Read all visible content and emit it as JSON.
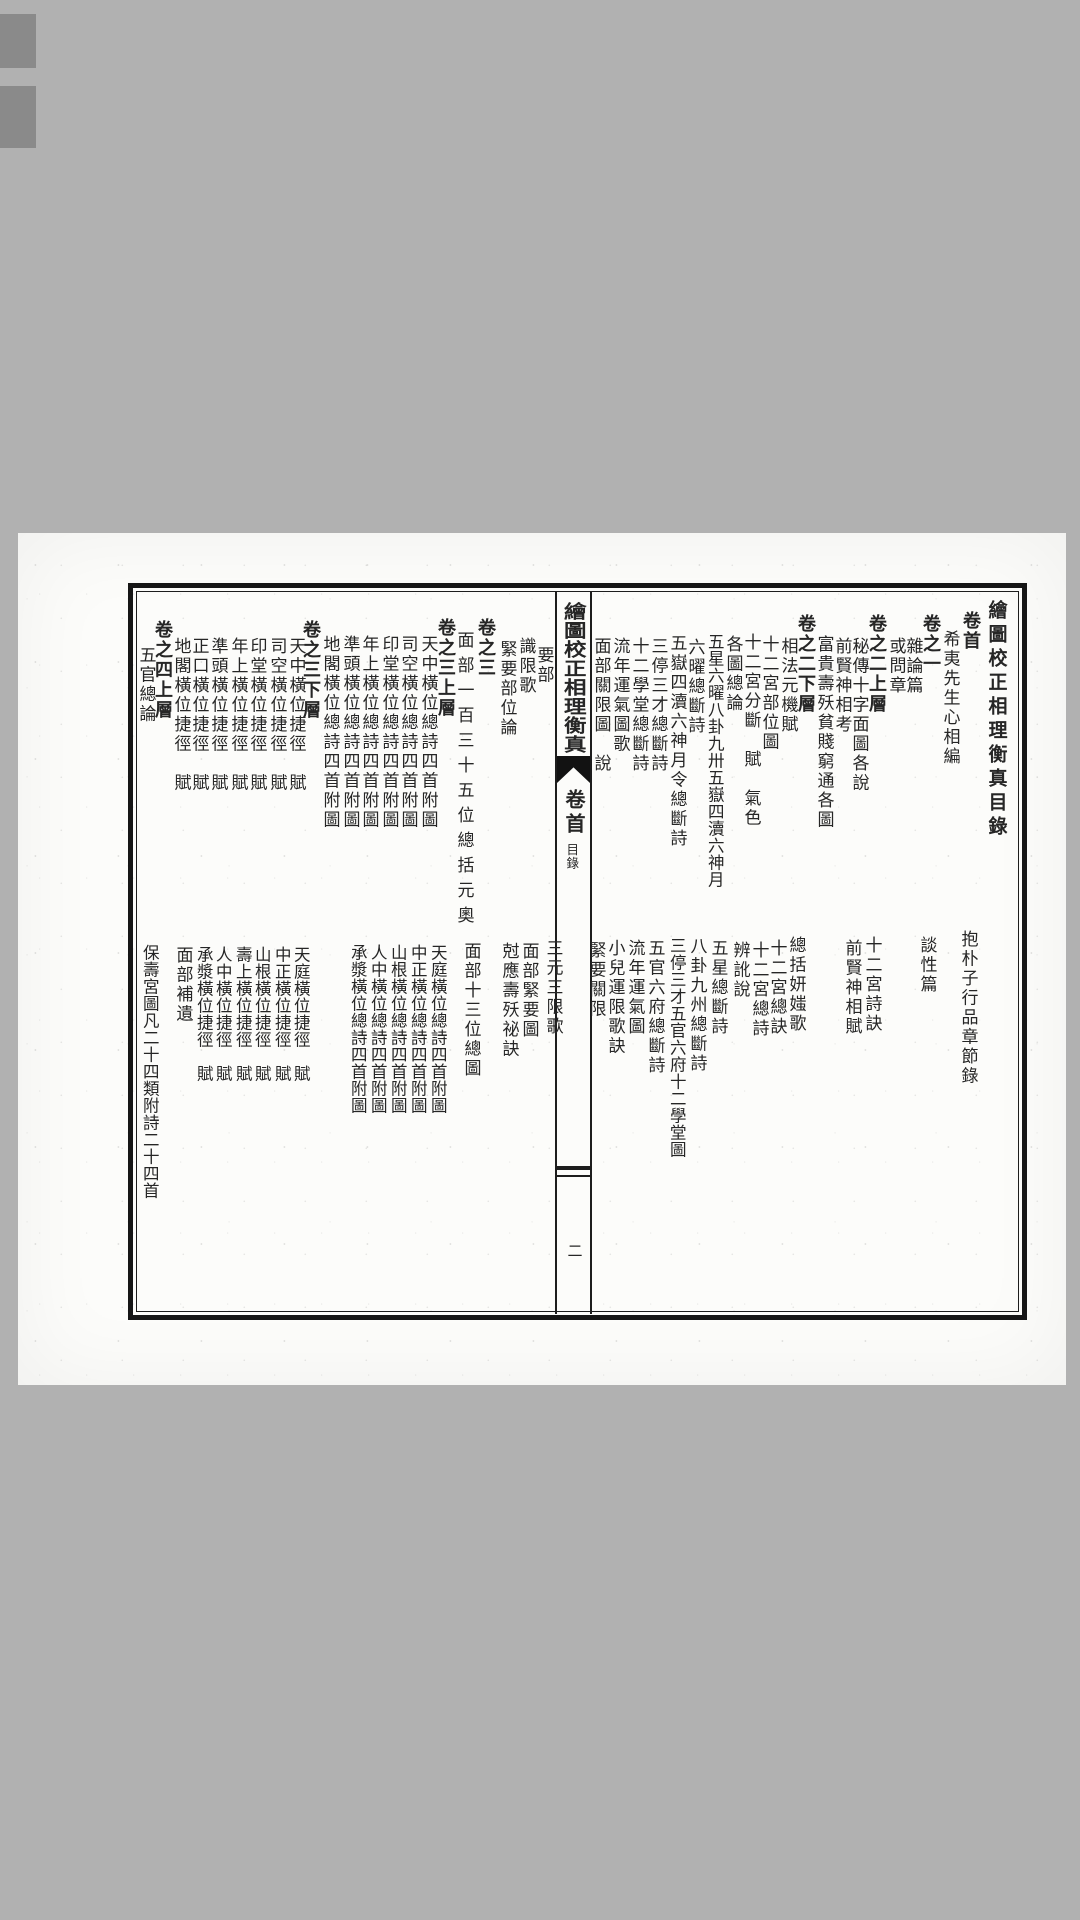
{
  "colors": {
    "backdrop": "#b1b1b1",
    "paper": "#fcfcfa",
    "ink": "#262626",
    "frame": "#161616"
  },
  "spine": {
    "title": "繪圖校正相理衡真",
    "volume": "卷首",
    "section": "目錄",
    "page_number": "二"
  },
  "right_page": {
    "top_columns": [
      {
        "text": "繪圖校正相理衡真目錄",
        "x": 996,
        "y": 600,
        "cls": "title-col"
      },
      {
        "text": "卷首",
        "x": 971,
        "y": 611,
        "cls": "header"
      },
      {
        "text": "希夷先生心相編",
        "x": 950,
        "y": 630
      },
      {
        "text": "卷之一",
        "x": 931,
        "y": 614,
        "cls": "header"
      },
      {
        "text": "雜論篇",
        "x": 913,
        "y": 637
      },
      {
        "text": "或問章",
        "x": 896,
        "y": 637
      },
      {
        "text": "卷之二上層",
        "x": 877,
        "y": 614,
        "cls": "header"
      },
      {
        "text": "秘傳十字面圖各說",
        "x": 859,
        "y": 637
      },
      {
        "text": "前賢神相考",
        "x": 842,
        "y": 637
      },
      {
        "text": "富貴壽殀貧賤窮通各圖",
        "x": 824,
        "y": 635
      },
      {
        "text": "卷之二下層",
        "x": 806,
        "y": 614,
        "cls": "header"
      },
      {
        "text": "相法元機賦",
        "x": 788,
        "y": 637
      },
      {
        "text": "十二宮部位圖",
        "x": 769,
        "y": 635
      },
      {
        "text": "十二宮分斷　賦　氣色",
        "x": 751,
        "y": 633
      },
      {
        "text": "各圖總論",
        "x": 733,
        "y": 635
      },
      {
        "text": "五星六曜八卦九卅五嶽四瀆六神月",
        "x": 714,
        "y": 633,
        "cls": "tight"
      },
      {
        "text": "六曜總斷詩",
        "x": 695,
        "y": 638
      },
      {
        "text": "五嶽四瀆六神月令總斷詩",
        "x": 677,
        "y": 634
      },
      {
        "text": "三停三才總斷詩",
        "x": 658,
        "y": 637
      },
      {
        "text": "十二學堂總斷詩",
        "x": 639,
        "y": 637
      },
      {
        "text": "流年運氣圖歌",
        "x": 620,
        "y": 637
      },
      {
        "text": "面部關限圖　說",
        "x": 601,
        "y": 637
      }
    ],
    "bottom_columns": [
      {
        "text": "抱朴子行品章節錄",
        "x": 968,
        "y": 930
      },
      {
        "text": "談性篇",
        "x": 927,
        "y": 936
      },
      {
        "text": "十二宮詩訣",
        "x": 872,
        "y": 936
      },
      {
        "text": "前賢神相賦",
        "x": 852,
        "y": 939
      },
      {
        "text": "總括妍媸歌",
        "x": 796,
        "y": 936
      },
      {
        "text": "十二宮總訣",
        "x": 777,
        "y": 939
      },
      {
        "text": "十二宮總詩",
        "x": 759,
        "y": 941
      },
      {
        "text": "辨訛說",
        "x": 740,
        "y": 941
      },
      {
        "text": "五星總斷詩",
        "x": 718,
        "y": 939
      },
      {
        "text": "八卦九州總斷詩",
        "x": 697,
        "y": 937
      },
      {
        "text": "三停三才五官六府十二學堂圖",
        "x": 676,
        "y": 937,
        "cls": "tight"
      },
      {
        "text": "五官六府總斷詩",
        "x": 655,
        "y": 939
      },
      {
        "text": "流年運氣圖",
        "x": 635,
        "y": 939
      },
      {
        "text": "小兒運限歌訣",
        "x": 615,
        "y": 939
      },
      {
        "text": "緊要關限",
        "x": 596,
        "y": 941
      }
    ]
  },
  "left_page": {
    "top_columns": [
      {
        "text": "要部",
        "x": 544,
        "y": 646
      },
      {
        "text": "識限歌",
        "x": 526,
        "y": 637
      },
      {
        "text": "緊要部位論",
        "x": 507,
        "y": 640
      },
      {
        "text": "卷之三",
        "x": 486,
        "y": 618,
        "cls": "header"
      },
      {
        "text": "面部一百三十五位總括元奧",
        "x": 464,
        "y": 631,
        "cls": "loose"
      },
      {
        "text": "卷之三上層",
        "x": 446,
        "y": 618,
        "cls": "header"
      },
      {
        "text": "天中橫位總詩四首附圖",
        "x": 428,
        "y": 635
      },
      {
        "text": "司空橫位總詩四首附圖",
        "x": 408,
        "y": 635
      },
      {
        "text": "印堂橫位總詩四首附圖",
        "x": 389,
        "y": 635
      },
      {
        "text": "年上橫位總詩四首附圖",
        "x": 369,
        "y": 635
      },
      {
        "text": "準頭橫位總詩四首附圖",
        "x": 350,
        "y": 635
      },
      {
        "text": "地閣橫位總詩四首附圖",
        "x": 330,
        "y": 635
      },
      {
        "text": "卷之三下層",
        "x": 311,
        "y": 620,
        "cls": "header"
      },
      {
        "text": "天中橫位捷徑　賦",
        "x": 296,
        "y": 637
      },
      {
        "text": "司空橫位捷徑　賦",
        "x": 277,
        "y": 637
      },
      {
        "text": "印堂橫位捷徑　賦",
        "x": 257,
        "y": 637
      },
      {
        "text": "年上橫位捷徑　賦",
        "x": 238,
        "y": 637
      },
      {
        "text": "準頭橫位捷徑　賦",
        "x": 218,
        "y": 637
      },
      {
        "text": "正口橫位捷徑　賦",
        "x": 199,
        "y": 637
      },
      {
        "text": "地閣橫位捷徑　賦",
        "x": 181,
        "y": 637
      },
      {
        "text": "卷之四上層",
        "x": 163,
        "y": 620,
        "cls": "header"
      },
      {
        "text": "五官總論",
        "x": 146,
        "y": 646
      }
    ],
    "bottom_columns": [
      {
        "text": "三元三限歌",
        "x": 553,
        "y": 939
      },
      {
        "text": "面部緊要圖",
        "x": 529,
        "y": 942
      },
      {
        "text": "尅應壽殀祕訣",
        "x": 509,
        "y": 942
      },
      {
        "text": "面部十三位總圖",
        "x": 471,
        "y": 942
      },
      {
        "text": "天庭橫位總詩四首附圖",
        "x": 437,
        "y": 944,
        "cls": "tight"
      },
      {
        "text": "中正橫位總詩四首附圖",
        "x": 417,
        "y": 944,
        "cls": "tight"
      },
      {
        "text": "山根橫位總詩四首附圖",
        "x": 397,
        "y": 944,
        "cls": "tight"
      },
      {
        "text": "人中橫位總詩四首附圖",
        "x": 377,
        "y": 944,
        "cls": "tight"
      },
      {
        "text": "承漿橫位總詩四首附圖",
        "x": 357,
        "y": 944,
        "cls": "tight"
      },
      {
        "text": "天庭橫位捷徑　賦",
        "x": 300,
        "y": 946,
        "cls": "tight"
      },
      {
        "text": "中正橫位捷徑　賦",
        "x": 281,
        "y": 946,
        "cls": "tight"
      },
      {
        "text": "山根橫位捷徑　賦",
        "x": 261,
        "y": 946,
        "cls": "tight"
      },
      {
        "text": "壽上橫位捷徑　賦",
        "x": 242,
        "y": 946,
        "cls": "tight"
      },
      {
        "text": "人中橫位捷徑　賦",
        "x": 222,
        "y": 946,
        "cls": "tight"
      },
      {
        "text": "承漿橫位捷徑　賦",
        "x": 203,
        "y": 946,
        "cls": "tight"
      },
      {
        "text": "面部補遺",
        "x": 183,
        "y": 946
      },
      {
        "text": "保壽宮圖凡二十四類附詩二十四首",
        "x": 149,
        "y": 944,
        "cls": "tight"
      }
    ]
  }
}
